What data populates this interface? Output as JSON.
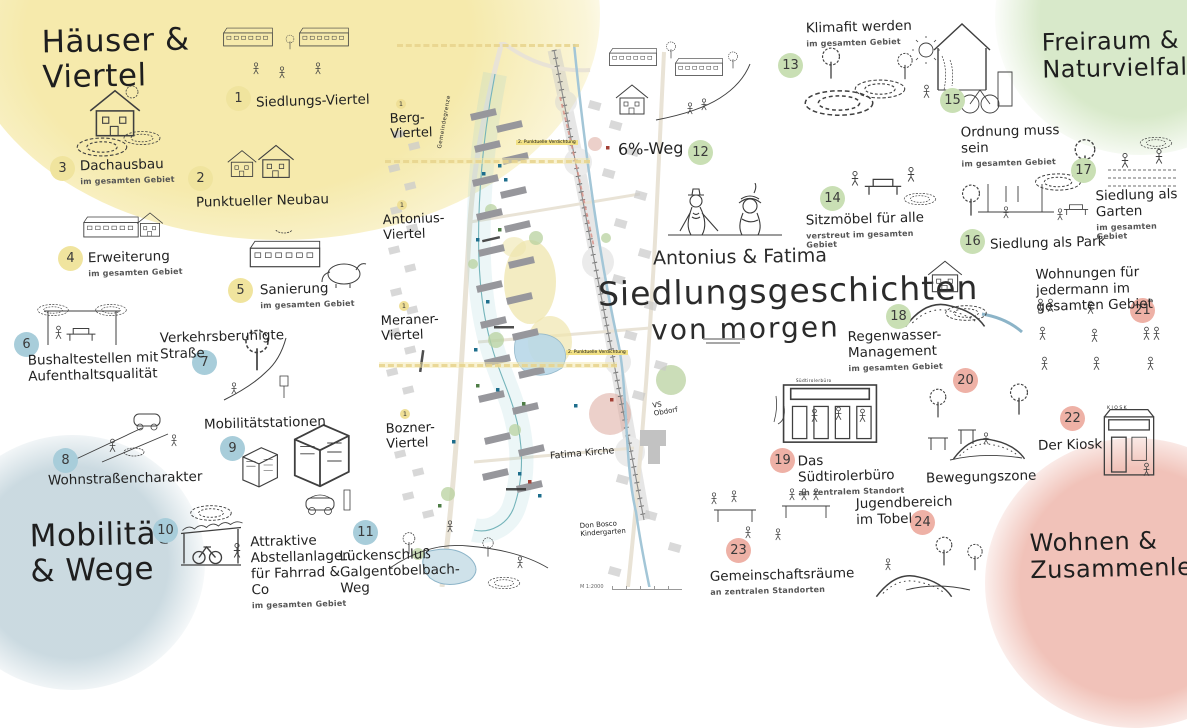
{
  "title": {
    "names": "Antonius & Fatima",
    "line1": "Siedlungsgeschichten",
    "line2": "von morgen"
  },
  "themes": [
    {
      "line1": "Häuser &",
      "line2": "Viertel",
      "color": "#f3e9ae"
    },
    {
      "line1": "Freiraum &",
      "line2": "Naturvielfalt",
      "color": "#dcedd0"
    },
    {
      "line1": "Mobilität",
      "line2": "& Wege",
      "color": "#ccdde4"
    },
    {
      "line1": "Wohnen &",
      "line2": "Zusammenleben",
      "color": "#f2c3b9"
    }
  ],
  "items": [
    {
      "num": 1,
      "label": "Siedlungs-Viertel",
      "color": "#f0e49e"
    },
    {
      "num": 2,
      "label": "Punktueller Neubau",
      "color": "#f0e49e"
    },
    {
      "num": 3,
      "label": "Dachausbau",
      "sub": "im gesamten Gebiet",
      "color": "#f0e49e"
    },
    {
      "num": 4,
      "label": "Erweiterung",
      "sub": "im gesamten Gebiet",
      "color": "#f0e49e"
    },
    {
      "num": 5,
      "label": "Sanierung",
      "sub": "im gesamten Gebiet",
      "color": "#f0e49e"
    },
    {
      "num": 6,
      "label": "Bushaltestellen mit Aufenthaltsqualität",
      "color": "#a8cdda"
    },
    {
      "num": 7,
      "label": "Verkehrsberuhigte Straße",
      "color": "#a8cdda"
    },
    {
      "num": 8,
      "label": "Wohnstraßencharakter",
      "color": "#a8cdda"
    },
    {
      "num": 9,
      "label": "Mobilitätstationen",
      "color": "#a8cdda"
    },
    {
      "num": 10,
      "label": "Attraktive Abstellanlagen für Fahrrad & Co",
      "sub": "im gesamten Gebiet",
      "color": "#a8cdda"
    },
    {
      "num": 11,
      "label": "Lückenschluß Galgentobelbach-Weg",
      "color": "#a8cdda"
    },
    {
      "num": 12,
      "label": "6%-Weg",
      "color": "#c9dfb4"
    },
    {
      "num": 13,
      "label": "Klimafit werden",
      "sub": "im gesamten Gebiet",
      "color": "#c9dfb4"
    },
    {
      "num": 14,
      "label": "Sitzmöbel für alle",
      "sub": "verstreut im gesamten Gebiet",
      "color": "#c9dfb4"
    },
    {
      "num": 15,
      "label": "Ordnung muss sein",
      "sub": "im gesamten Gebiet",
      "color": "#c9dfb4"
    },
    {
      "num": 16,
      "label": "Siedlung als Park",
      "color": "#c9dfb4"
    },
    {
      "num": 17,
      "label": "Siedlung als Garten",
      "sub": "im gesamten Gebiet",
      "color": "#c9dfb4"
    },
    {
      "num": 18,
      "label": "Regenwasser-Management",
      "sub": "im gesamten Gebiet",
      "color": "#c9dfb4"
    },
    {
      "num": 19,
      "label": "Das Südtirolerbüro",
      "sub": "an zentralem Standort",
      "color": "#eeb1a6"
    },
    {
      "num": 20,
      "label": "Bewegungszone",
      "color": "#eeb1a6"
    },
    {
      "num": 21,
      "label": "Wohnungen für jedermann im gesamten Gebiet",
      "color": "#eeb1a6"
    },
    {
      "num": 22,
      "label": "Der Kiosk",
      "color": "#eeb1a6"
    },
    {
      "num": 23,
      "label": "Gemeinschaftsräume",
      "sub": "an zentralen Standorten",
      "color": "#eeb1a6"
    },
    {
      "num": 24,
      "label": "Jugendbereich im Tobel",
      "color": "#eeb1a6"
    }
  ],
  "map": {
    "quarters": [
      [
        "Berg-",
        "Viertel"
      ],
      [
        "Antonius-",
        "Viertel"
      ],
      [
        "Meraner-",
        "Viertel"
      ],
      [
        "Bozner-",
        "Viertel"
      ]
    ],
    "quarter_marker": "1",
    "labels": {
      "gemeindegrenze": "Gemeindegrenze",
      "verdichtung": "2. Punktuelle Verdichtung",
      "fatima_kirche": "Fatima Kirche",
      "kindergarten": "Don Bosco Kindergarten",
      "vs": "VS Obdorf",
      "scale": "M 1:2000"
    }
  },
  "signs": {
    "kiosk": "KIOSK",
    "suedtirolerbuero": "Südtirolerbüro"
  }
}
